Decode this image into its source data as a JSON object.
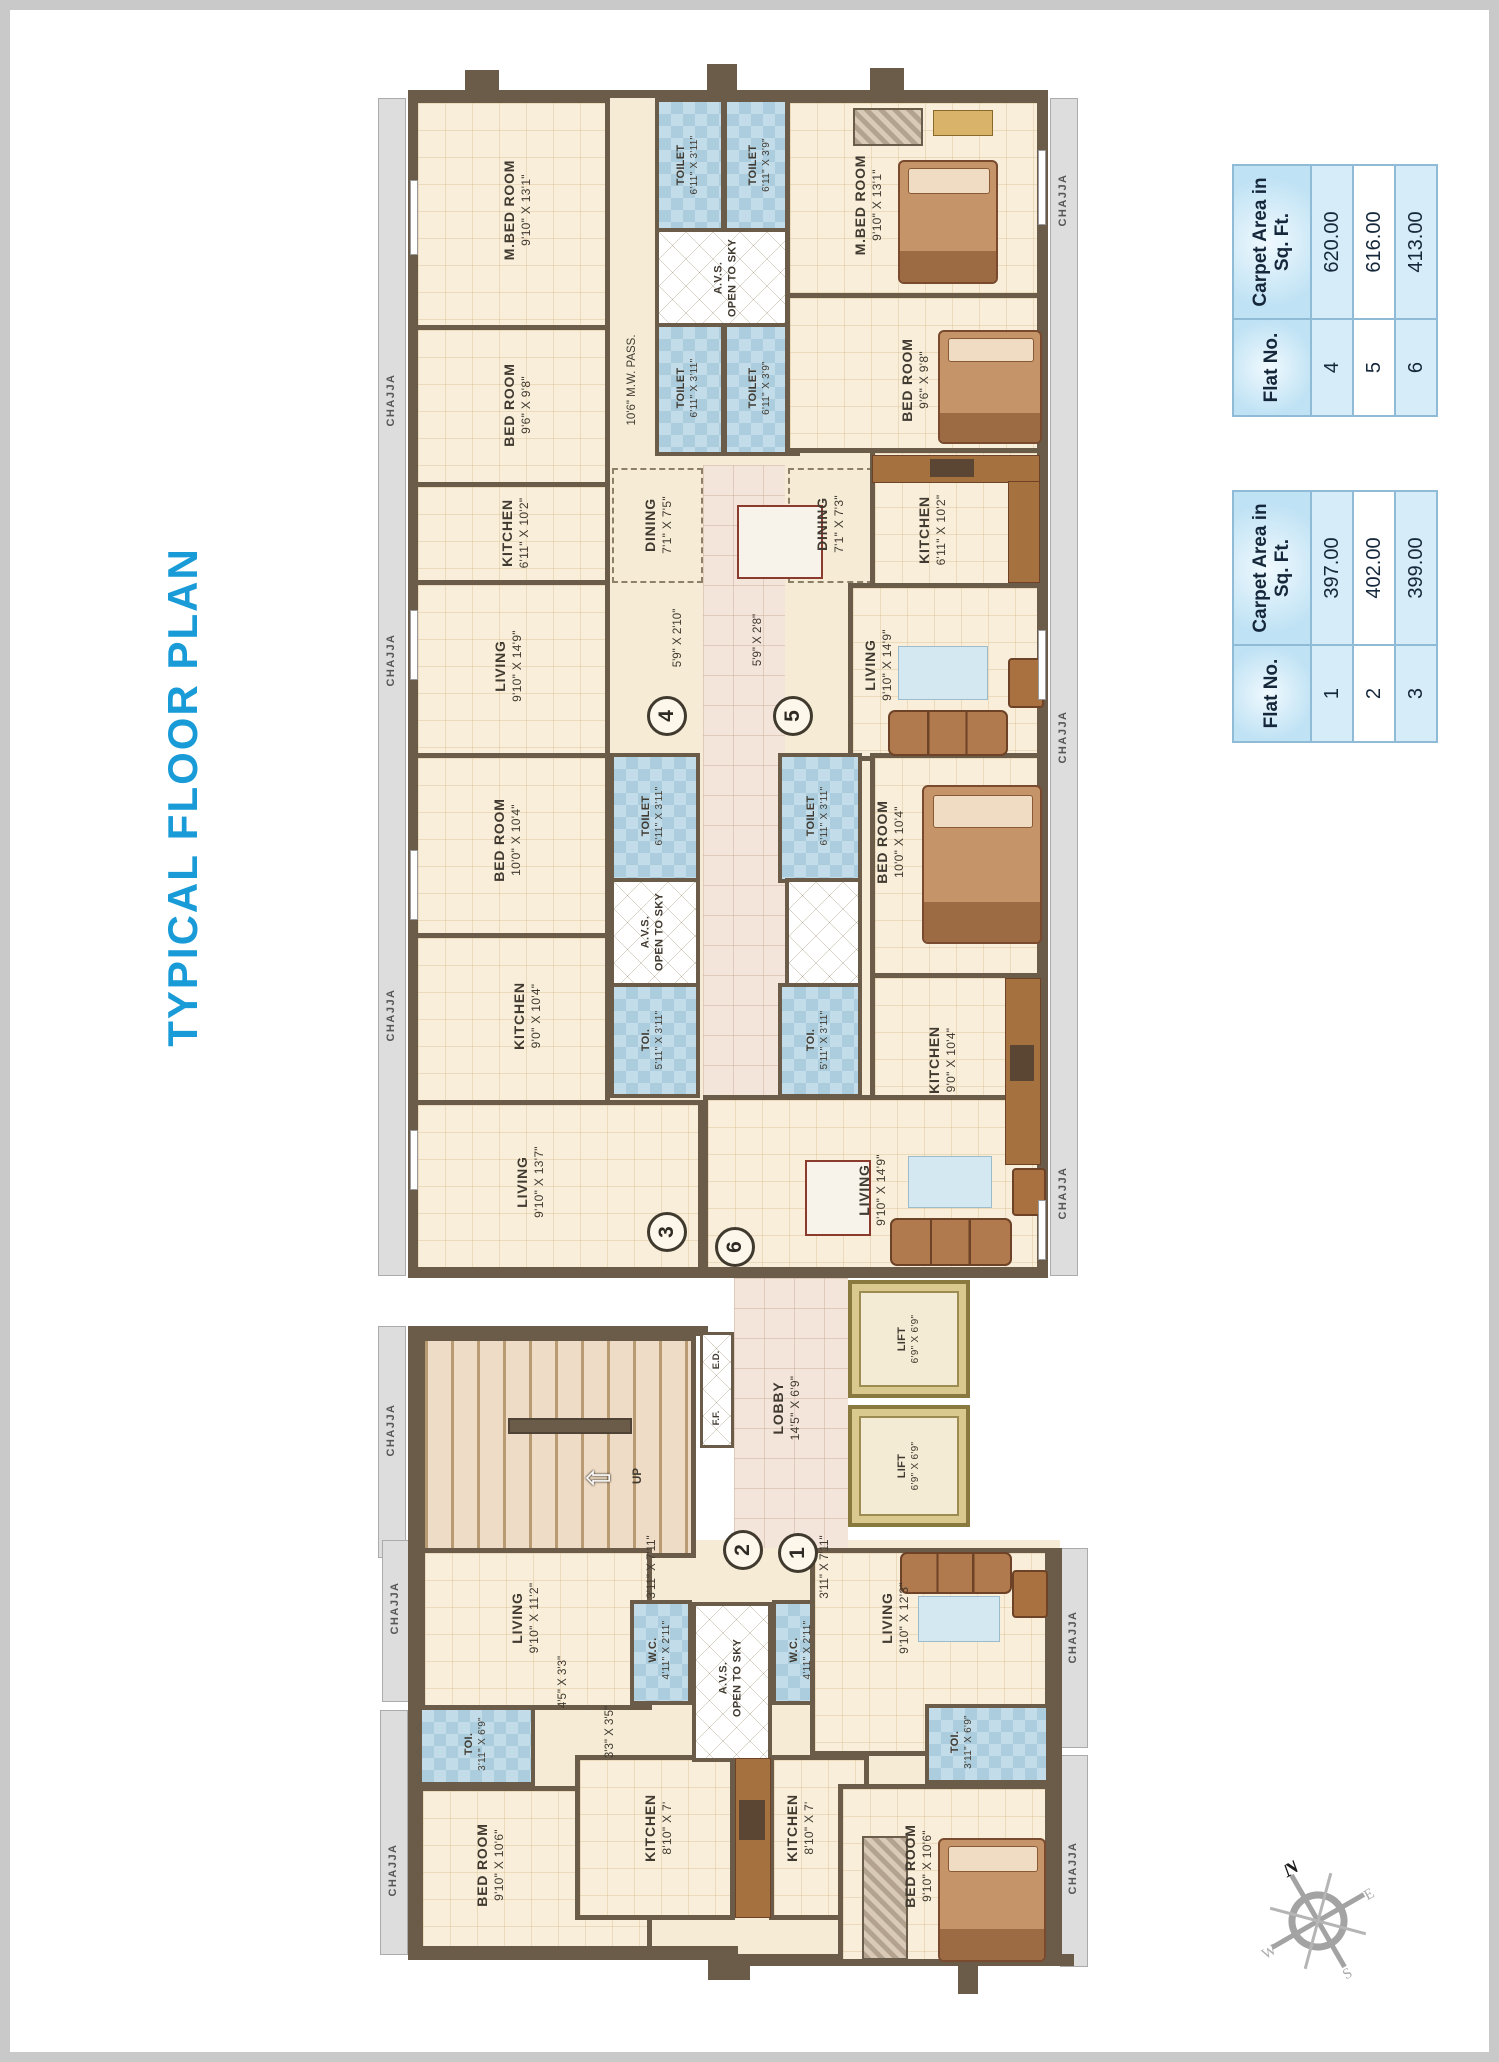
{
  "title": "TYPICAL FLOOR PLAN",
  "tables": {
    "upper": {
      "col_flat": "Flat No.",
      "col_area": "Carpet Area in Sq. Ft.",
      "rows": [
        {
          "flat": "4",
          "area": "620.00"
        },
        {
          "flat": "5",
          "area": "616.00"
        },
        {
          "flat": "6",
          "area": "413.00"
        }
      ]
    },
    "lower": {
      "col_flat": "Flat No.",
      "col_area": "Carpet Area in Sq. Ft.",
      "rows": [
        {
          "flat": "1",
          "area": "397.00"
        },
        {
          "flat": "2",
          "area": "402.00"
        },
        {
          "flat": "3",
          "area": "399.00"
        }
      ]
    }
  },
  "rooms": {
    "mbed4": {
      "name": "M.BED ROOM",
      "dims": "9'10\" X 13'1\""
    },
    "bed4": {
      "name": "BED ROOM",
      "dims": "9'6\" X 9'8\""
    },
    "kit4": {
      "name": "KITCHEN",
      "dims": "6'11\" X 10'2\""
    },
    "liv4": {
      "name": "LIVING",
      "dims": "9'10\" X 14'9\""
    },
    "din4": {
      "name": "DINING",
      "dims": "7'1\" X 7'5\""
    },
    "t4a": {
      "name": "TOILET",
      "dims": "6'11\" X 3'11\""
    },
    "t4b": {
      "name": "TOILET",
      "dims": "6'11\" X 3'9\""
    },
    "avs4": {
      "name": "A.V.S.",
      "dims": "OPEN TO SKY"
    },
    "t4c": {
      "name": "TOILET",
      "dims": "6'11\" X 3'11\""
    },
    "t4d": {
      "name": "TOILET",
      "dims": "6'11\" X 3'9\""
    },
    "mbed5": {
      "name": "M.BED ROOM",
      "dims": "9'10\" X 13'1\""
    },
    "bed5": {
      "name": "BED ROOM",
      "dims": "9'6\" X 9'8\""
    },
    "kit5": {
      "name": "KITCHEN",
      "dims": "6'11\" X 10'2\""
    },
    "din5": {
      "name": "DINING",
      "dims": "7'1\" X 7'3\""
    },
    "liv5": {
      "name": "LIVING",
      "dims": "9'10\" X 14'9\""
    },
    "bed3": {
      "name": "BED ROOM",
      "dims": "10'0\" X 10'4\""
    },
    "kit3": {
      "name": "KITCHEN",
      "dims": "9'0\" X 10'4\""
    },
    "liv3": {
      "name": "LIVING",
      "dims": "9'10\" X 13'7\""
    },
    "t3": {
      "name": "TOILET",
      "dims": "6'11\" X 3'11\""
    },
    "avs3": {
      "name": "A.V.S.",
      "dims": "OPEN TO SKY"
    },
    "toi3": {
      "name": "TOI.",
      "dims": "5'11\" X 3'11\""
    },
    "bed6": {
      "name": "BED ROOM",
      "dims": "10'0\" X 10'4\""
    },
    "kit6": {
      "name": "KITCHEN",
      "dims": "9'0\" X 10'4\""
    },
    "liv6": {
      "name": "LIVING",
      "dims": "9'10\" X 14'9\""
    },
    "t6": {
      "name": "TOILET",
      "dims": "6'11\" X 3'11\""
    },
    "toi6": {
      "name": "TOI.",
      "dims": "5'11\" X 3'11\""
    },
    "lobby": {
      "name": "LOBBY",
      "dims": "14'5\" X 6'9\""
    },
    "lift": {
      "name": "LIFT",
      "dims": "6'9\" X 6'9\""
    },
    "liv2": {
      "name": "LIVING",
      "dims": "9'10\" X 11'2\""
    },
    "wc2": {
      "name": "W.C.",
      "dims": "4'11\" X 2'11\""
    },
    "avsb": {
      "name": "A.V.S.",
      "dims": "OPEN TO SKY"
    },
    "wc1": {
      "name": "W.C.",
      "dims": "4'11\" X 2'11\""
    },
    "kit2": {
      "name": "KITCHEN",
      "dims": "8'10\" X 7'"
    },
    "kit1": {
      "name": "KITCHEN",
      "dims": "8'10\" X 7'"
    },
    "toi2": {
      "name": "TOI.",
      "dims": "3'11\" X 6'9\""
    },
    "toi1": {
      "name": "TOI.",
      "dims": "3'11\" X 6'9\""
    },
    "bed2": {
      "name": "BED ROOM",
      "dims": "9'10\" X 10'6\""
    },
    "bed1": {
      "name": "BED ROOM",
      "dims": "9'10\" X 10'6\""
    },
    "liv1": {
      "name": "LIVING",
      "dims": "9'10\" X 12'3\""
    }
  },
  "passages": {
    "mw_pass": "10'6\" M.W. PASS.",
    "p4": "5'9\" X 2'10\"",
    "p5": "5'9\" X 2'8\"",
    "p_entry": "3'11\" X 7'11\"",
    "p33": "3'3\" X 3'5\"",
    "p45": "4'5\" X 3'3\""
  },
  "stairs": {
    "up": "UP",
    "ff": "F.F.",
    "ed": "E.D."
  },
  "markers": {
    "f1": "1",
    "f2": "2",
    "f3": "3",
    "f4": "4",
    "f5": "5",
    "f6": "6"
  },
  "chajja_label": "CHAJJA",
  "compass": {
    "n": "N",
    "e": "E",
    "s": "S",
    "w": "W"
  }
}
